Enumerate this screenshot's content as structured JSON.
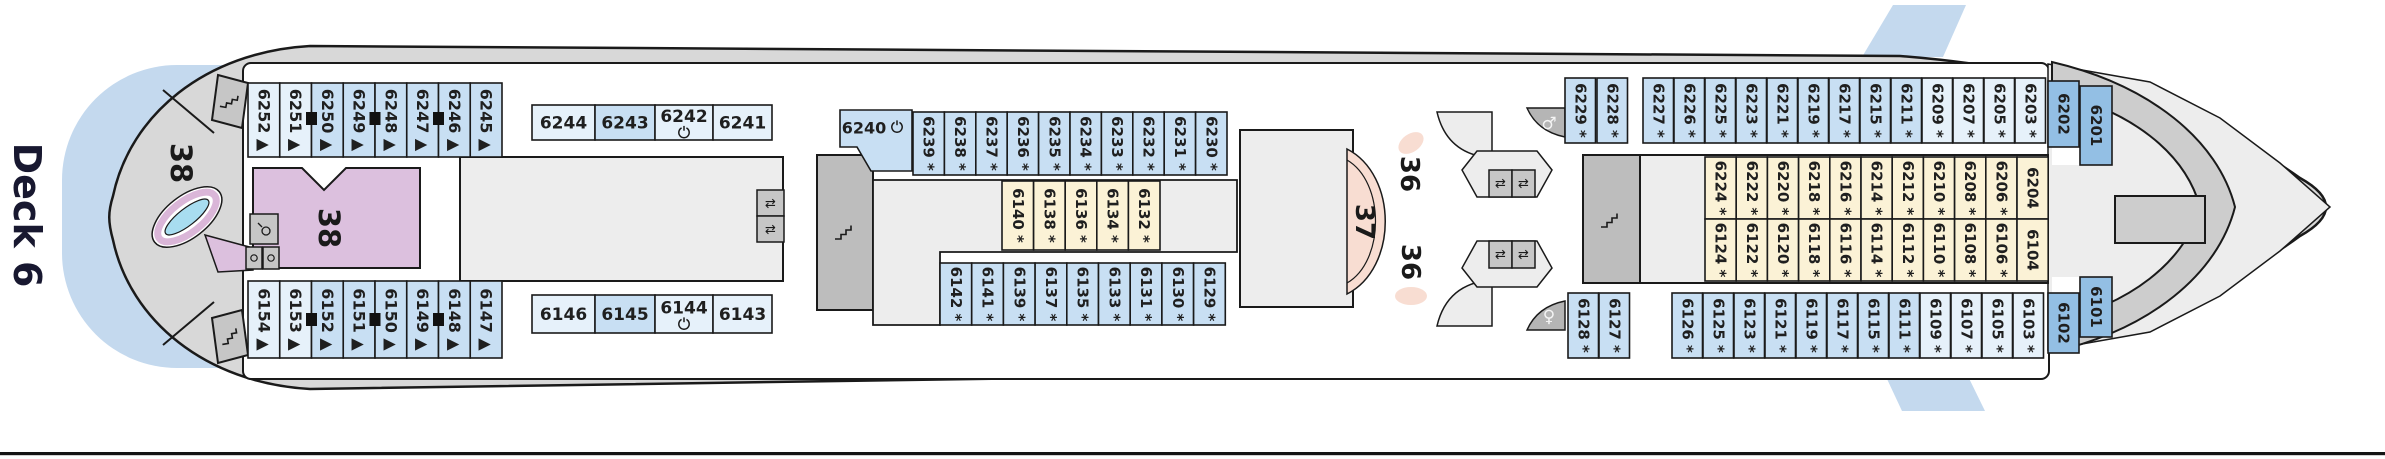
{
  "deck_label": "Deck 6",
  "area_labels": {
    "aft_deck": "38",
    "aft_room": "38",
    "stage": "37",
    "lounge_top": "36",
    "lounge_bottom": "36"
  },
  "markers": {
    "triangle": "▲",
    "asterisk": "*"
  },
  "colors": {
    "cabin_light": "#e6f1fa",
    "cabin_medium": "#c8dff3",
    "cabin_dark": "#93bfe4",
    "cabin_yellow": "#fbf2d6",
    "outline": "#1a1a1a",
    "hull": "#d8d8d8",
    "inner_grey": "#ededed",
    "stair_grey": "#bdbdbd",
    "water": "#c4d9ee",
    "pink_room": "#dcc0de",
    "stage_pink": "#f8ddd2",
    "pool_blue": "#a8ddf0",
    "pool_ring": "#dab6d8"
  },
  "cabin_groups": [
    {
      "id": "aft-top",
      "layout": "aft-top",
      "cabins": [
        {
          "number": "6252",
          "marker": "triangle",
          "shade": "light"
        },
        {
          "number": "6251",
          "marker": "triangle",
          "shade": "light"
        },
        {
          "number": "6250",
          "marker": "triangle",
          "shade": "medium"
        },
        {
          "number": "6249",
          "marker": "triangle",
          "shade": "medium"
        },
        {
          "number": "6248",
          "marker": "triangle",
          "shade": "medium"
        },
        {
          "number": "6247",
          "marker": "triangle",
          "shade": "medium"
        },
        {
          "number": "6246",
          "marker": "triangle",
          "shade": "medium"
        },
        {
          "number": "6245",
          "marker": "triangle",
          "shade": "medium"
        }
      ]
    },
    {
      "id": "aft-top-horizontal",
      "layout": "aft-top-h",
      "cabins": [
        {
          "number": "6244",
          "shade": "light"
        },
        {
          "number": "6243",
          "shade": "medium"
        },
        {
          "number": "6242",
          "shade": "light",
          "icon": "accessible"
        },
        {
          "number": "6241",
          "shade": "light"
        }
      ]
    },
    {
      "id": "cabin-6240",
      "layout": "cabin-6240",
      "cabins": [
        {
          "number": "6240",
          "shade": "medium",
          "icon": "accessible"
        }
      ]
    },
    {
      "id": "mid-top",
      "layout": "mid-top",
      "cabins": [
        {
          "number": "6239",
          "marker": "asterisk",
          "shade": "medium"
        },
        {
          "number": "6238",
          "marker": "asterisk",
          "shade": "medium"
        },
        {
          "number": "6237",
          "marker": "asterisk",
          "shade": "medium"
        },
        {
          "number": "6236",
          "marker": "asterisk",
          "shade": "medium"
        },
        {
          "number": "6235",
          "marker": "asterisk",
          "shade": "medium"
        },
        {
          "number": "6234",
          "marker": "asterisk",
          "shade": "medium"
        },
        {
          "number": "6233",
          "marker": "asterisk",
          "shade": "medium"
        },
        {
          "number": "6232",
          "marker": "asterisk",
          "shade": "medium"
        },
        {
          "number": "6231",
          "marker": "asterisk",
          "shade": "medium"
        },
        {
          "number": "6230",
          "marker": "asterisk",
          "shade": "medium"
        }
      ]
    },
    {
      "id": "mid-yellow",
      "layout": "mid-yellow",
      "cabins": [
        {
          "number": "6140",
          "marker": "asterisk",
          "shade": "yellow"
        },
        {
          "number": "6138",
          "marker": "asterisk",
          "shade": "yellow"
        },
        {
          "number": "6136",
          "marker": "asterisk",
          "shade": "yellow"
        },
        {
          "number": "6134",
          "marker": "asterisk",
          "shade": "yellow"
        },
        {
          "number": "6132",
          "marker": "asterisk",
          "shade": "yellow"
        }
      ]
    },
    {
      "id": "fwd-top",
      "layout": "fwd-top",
      "cabins": [
        {
          "number": "6229",
          "marker": "asterisk",
          "shade": "medium"
        },
        {
          "number": "6228",
          "marker": "asterisk",
          "shade": "medium"
        },
        {
          "number": "6227",
          "marker": "asterisk",
          "shade": "medium"
        },
        {
          "number": "6226",
          "marker": "asterisk",
          "shade": "medium"
        },
        {
          "number": "6225",
          "marker": "asterisk",
          "shade": "medium"
        },
        {
          "number": "6223",
          "marker": "asterisk",
          "shade": "medium"
        },
        {
          "number": "6221",
          "marker": "asterisk",
          "shade": "medium"
        },
        {
          "number": "6219",
          "marker": "asterisk",
          "shade": "medium"
        },
        {
          "number": "6217",
          "marker": "asterisk",
          "shade": "medium"
        },
        {
          "number": "6215",
          "marker": "asterisk",
          "shade": "medium"
        },
        {
          "number": "6211",
          "marker": "asterisk",
          "shade": "medium"
        },
        {
          "number": "6209",
          "marker": "asterisk",
          "shade": "light"
        },
        {
          "number": "6207",
          "marker": "asterisk",
          "shade": "light"
        },
        {
          "number": "6205",
          "marker": "asterisk",
          "shade": "light"
        },
        {
          "number": "6203",
          "marker": "asterisk",
          "shade": "light"
        },
        {
          "number": "6202",
          "shade": "dark"
        },
        {
          "number": "6201",
          "shade": "dark"
        }
      ]
    },
    {
      "id": "right-yellow-upper",
      "layout": "right-yellow-upper",
      "cabins": [
        {
          "number": "6224",
          "marker": "asterisk",
          "shade": "yellow"
        },
        {
          "number": "6222",
          "marker": "asterisk",
          "shade": "yellow"
        },
        {
          "number": "6220",
          "marker": "asterisk",
          "shade": "yellow"
        },
        {
          "number": "6218",
          "marker": "asterisk",
          "shade": "yellow"
        },
        {
          "number": "6216",
          "marker": "asterisk",
          "shade": "yellow"
        },
        {
          "number": "6214",
          "marker": "asterisk",
          "shade": "yellow"
        },
        {
          "number": "6212",
          "marker": "asterisk",
          "shade": "yellow"
        },
        {
          "number": "6210",
          "marker": "asterisk",
          "shade": "yellow"
        },
        {
          "number": "6208",
          "marker": "asterisk",
          "shade": "yellow"
        },
        {
          "number": "6206",
          "marker": "asterisk",
          "shade": "yellow"
        },
        {
          "number": "6204",
          "shade": "yellow"
        }
      ]
    },
    {
      "id": "right-yellow-lower",
      "layout": "right-yellow-lower",
      "cabins": [
        {
          "number": "6124",
          "marker": "asterisk",
          "shade": "yellow"
        },
        {
          "number": "6122",
          "marker": "asterisk",
          "shade": "yellow"
        },
        {
          "number": "6120",
          "marker": "asterisk",
          "shade": "yellow"
        },
        {
          "number": "6118",
          "marker": "asterisk",
          "shade": "yellow"
        },
        {
          "number": "6116",
          "marker": "asterisk",
          "shade": "yellow"
        },
        {
          "number": "6114",
          "marker": "asterisk",
          "shade": "yellow"
        },
        {
          "number": "6112",
          "marker": "asterisk",
          "shade": "yellow"
        },
        {
          "number": "6110",
          "marker": "asterisk",
          "shade": "yellow"
        },
        {
          "number": "6108",
          "marker": "asterisk",
          "shade": "yellow"
        },
        {
          "number": "6106",
          "marker": "asterisk",
          "shade": "yellow"
        },
        {
          "number": "6104",
          "shade": "yellow"
        }
      ]
    },
    {
      "id": "aft-bottom",
      "layout": "aft-bottom",
      "cabins": [
        {
          "number": "6154",
          "marker": "triangle",
          "shade": "light"
        },
        {
          "number": "6153",
          "marker": "triangle",
          "shade": "light"
        },
        {
          "number": "6152",
          "marker": "triangle",
          "shade": "medium"
        },
        {
          "number": "6151",
          "marker": "triangle",
          "shade": "medium"
        },
        {
          "number": "6150",
          "marker": "triangle",
          "shade": "medium"
        },
        {
          "number": "6149",
          "marker": "triangle",
          "shade": "medium"
        },
        {
          "number": "6148",
          "marker": "triangle",
          "shade": "medium"
        },
        {
          "number": "6147",
          "marker": "triangle",
          "shade": "medium"
        }
      ]
    },
    {
      "id": "aft-bottom-horizontal",
      "layout": "aft-bottom-h",
      "cabins": [
        {
          "number": "6146",
          "shade": "light"
        },
        {
          "number": "6145",
          "shade": "medium"
        },
        {
          "number": "6144",
          "shade": "light",
          "icon": "accessible"
        },
        {
          "number": "6143",
          "shade": "light"
        }
      ]
    },
    {
      "id": "mid-bottom",
      "layout": "mid-bottom",
      "cabins": [
        {
          "number": "6142",
          "marker": "asterisk",
          "shade": "medium"
        },
        {
          "number": "6141",
          "marker": "asterisk",
          "shade": "medium"
        },
        {
          "number": "6139",
          "marker": "asterisk",
          "shade": "medium"
        },
        {
          "number": "6137",
          "marker": "asterisk",
          "shade": "medium"
        },
        {
          "number": "6135",
          "marker": "asterisk",
          "shade": "medium"
        },
        {
          "number": "6133",
          "marker": "asterisk",
          "shade": "medium"
        },
        {
          "number": "6131",
          "marker": "asterisk",
          "shade": "medium"
        },
        {
          "number": "6130",
          "marker": "asterisk",
          "shade": "medium"
        },
        {
          "number": "6129",
          "marker": "asterisk",
          "shade": "medium"
        }
      ]
    },
    {
      "id": "fwd-bottom",
      "layout": "fwd-bottom",
      "cabins": [
        {
          "number": "6128",
          "marker": "asterisk",
          "shade": "medium"
        },
        {
          "number": "6127",
          "marker": "asterisk",
          "shade": "medium"
        },
        {
          "number": "6126",
          "marker": "asterisk",
          "shade": "medium"
        },
        {
          "number": "6125",
          "marker": "asterisk",
          "shade": "medium"
        },
        {
          "number": "6123",
          "marker": "asterisk",
          "shade": "medium"
        },
        {
          "number": "6121",
          "marker": "asterisk",
          "shade": "medium"
        },
        {
          "number": "6119",
          "marker": "asterisk",
          "shade": "medium"
        },
        {
          "number": "6117",
          "marker": "asterisk",
          "shade": "medium"
        },
        {
          "number": "6115",
          "marker": "asterisk",
          "shade": "medium"
        },
        {
          "number": "6111",
          "marker": "asterisk",
          "shade": "medium"
        },
        {
          "number": "6109",
          "marker": "asterisk",
          "shade": "light"
        },
        {
          "number": "6107",
          "marker": "asterisk",
          "shade": "light"
        },
        {
          "number": "6105",
          "marker": "asterisk",
          "shade": "light"
        },
        {
          "number": "6103",
          "marker": "asterisk",
          "shade": "light"
        },
        {
          "number": "6102",
          "shade": "dark"
        },
        {
          "number": "6101",
          "shade": "dark"
        }
      ]
    }
  ]
}
